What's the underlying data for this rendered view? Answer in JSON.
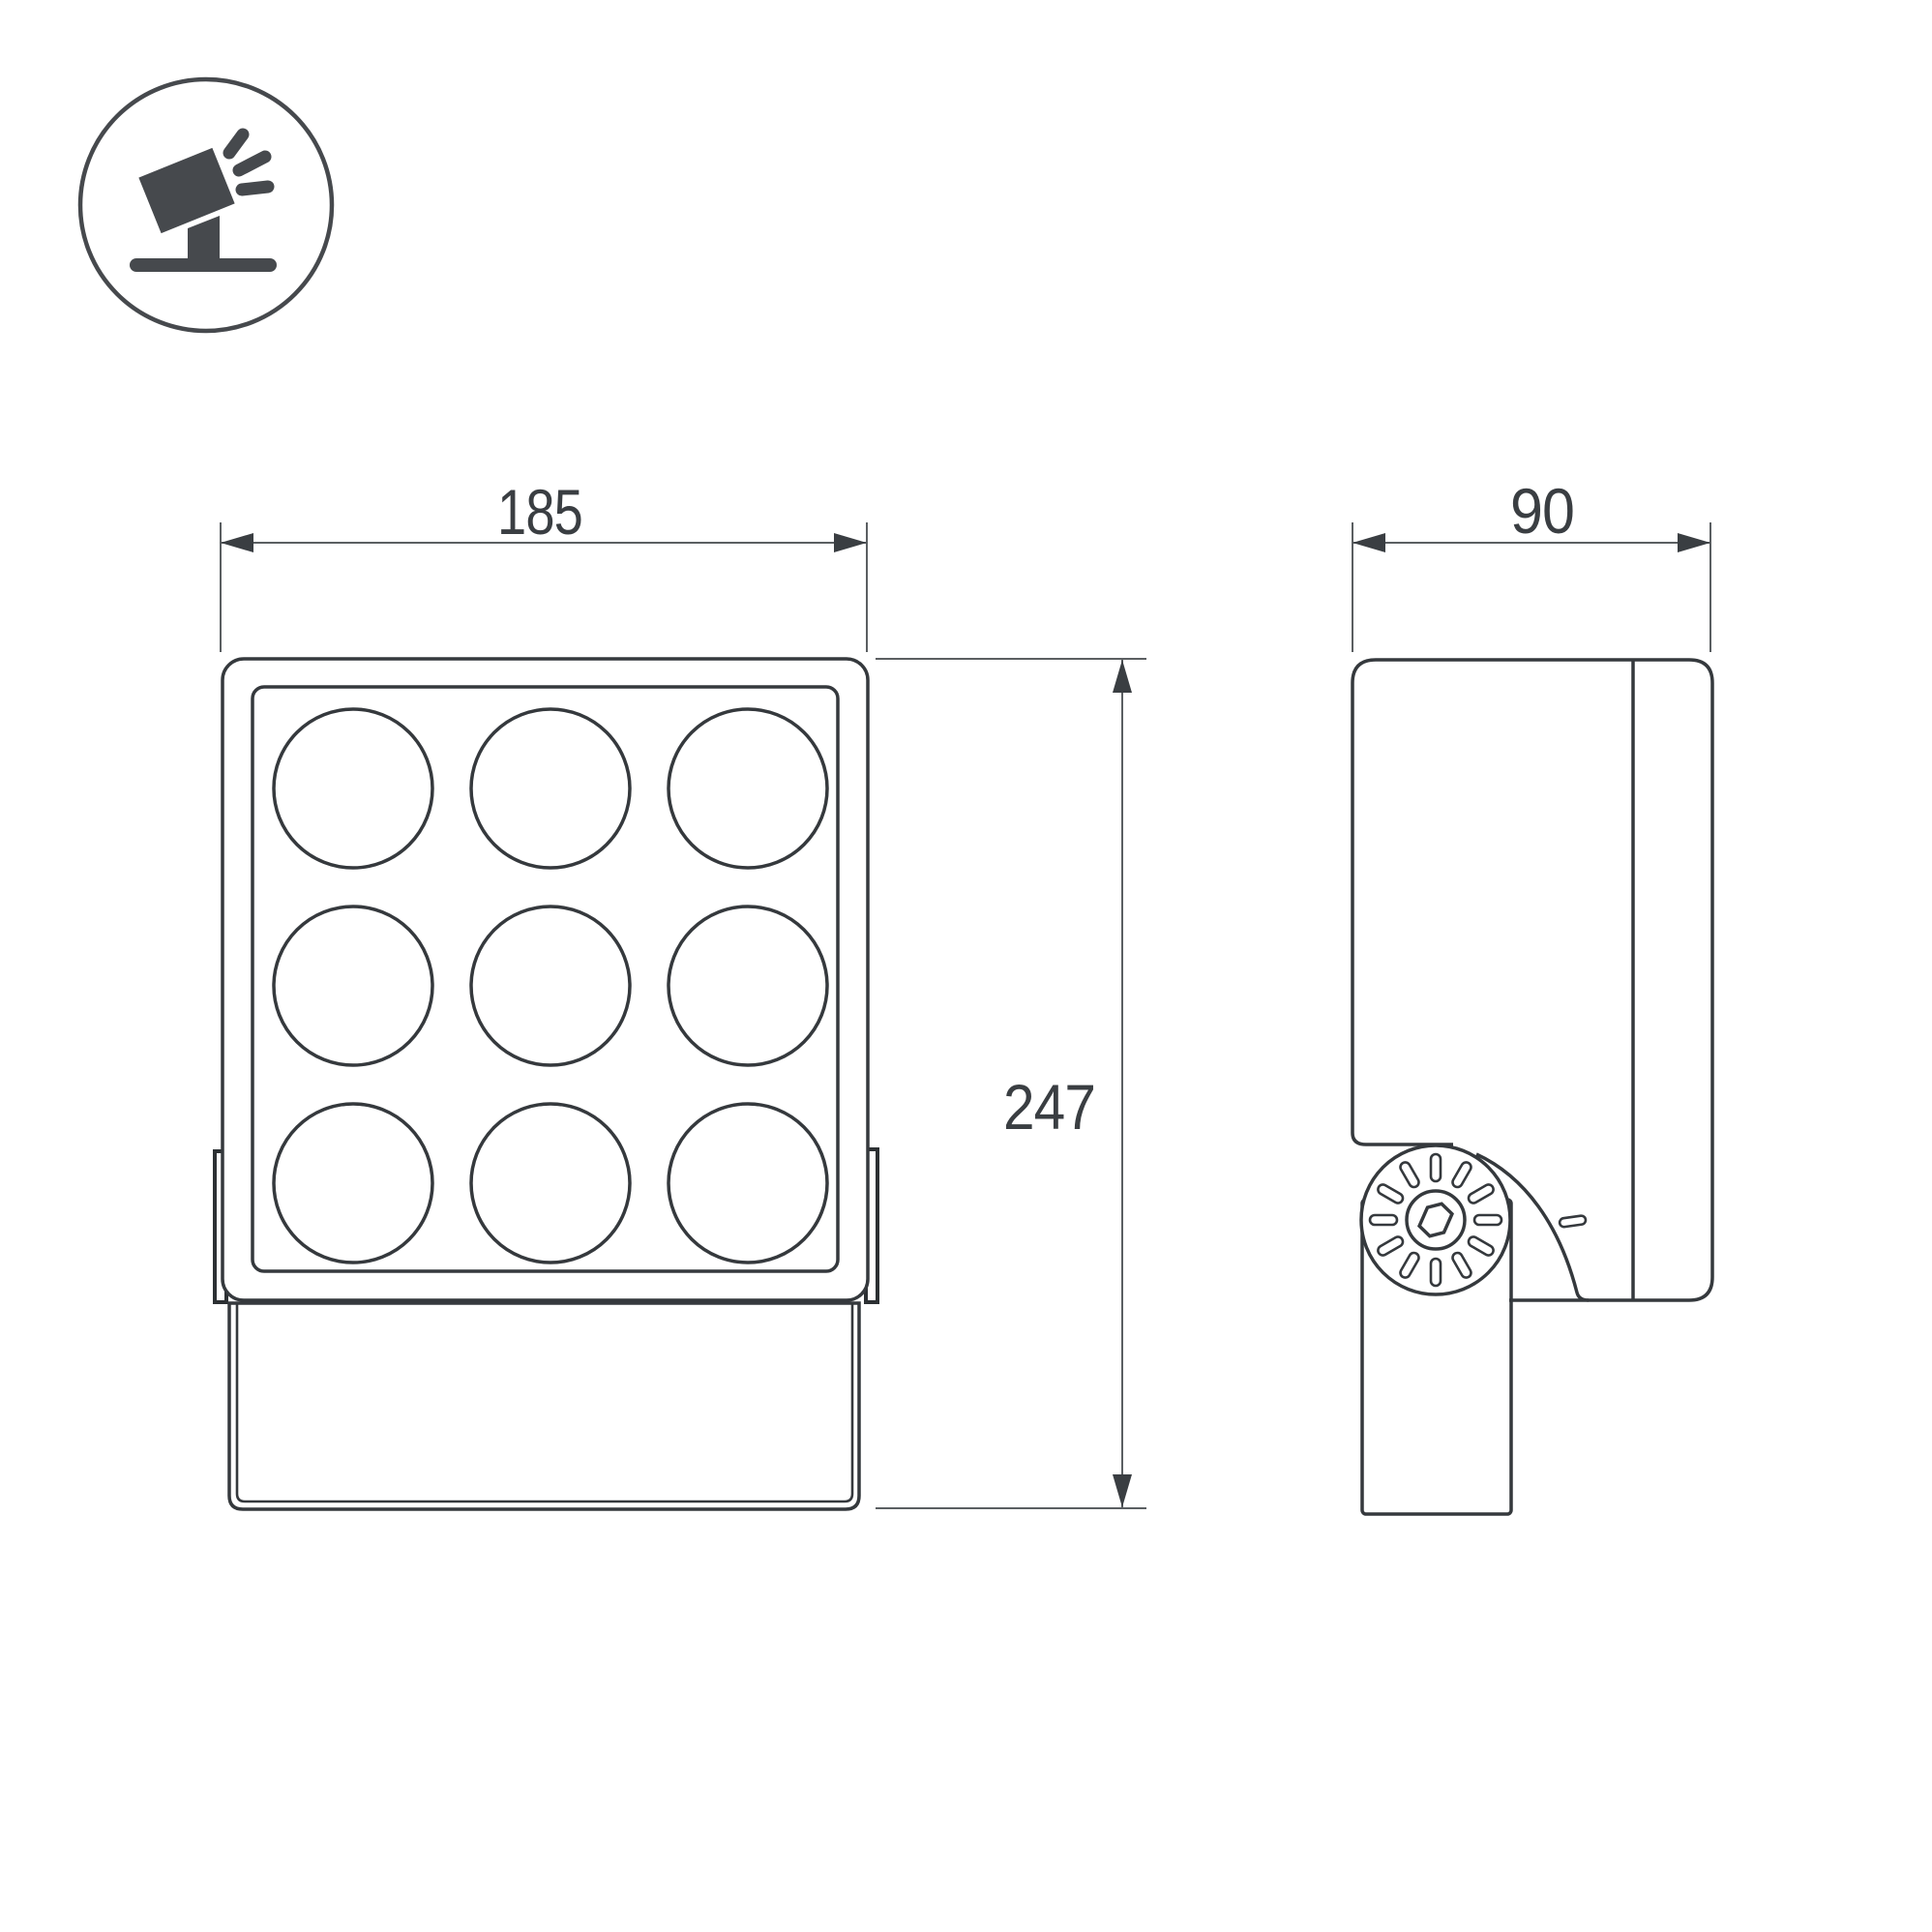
{
  "drawing": {
    "icon": {
      "name": "tilted-floodlight-on-stand",
      "description": "adjustable spotlight pictogram"
    },
    "front_view": {
      "width_label": "185",
      "height_label": "247",
      "led_grid": {
        "rows": 3,
        "cols": 3
      }
    },
    "side_view": {
      "width_label": "90",
      "knuckle_slot_count": 12
    },
    "colors": {
      "background": "#ffffff",
      "outline": "#35393d",
      "dimension_line": "#5b5f62",
      "text": "#3a3e42",
      "icon_fill": "#46494d"
    }
  }
}
